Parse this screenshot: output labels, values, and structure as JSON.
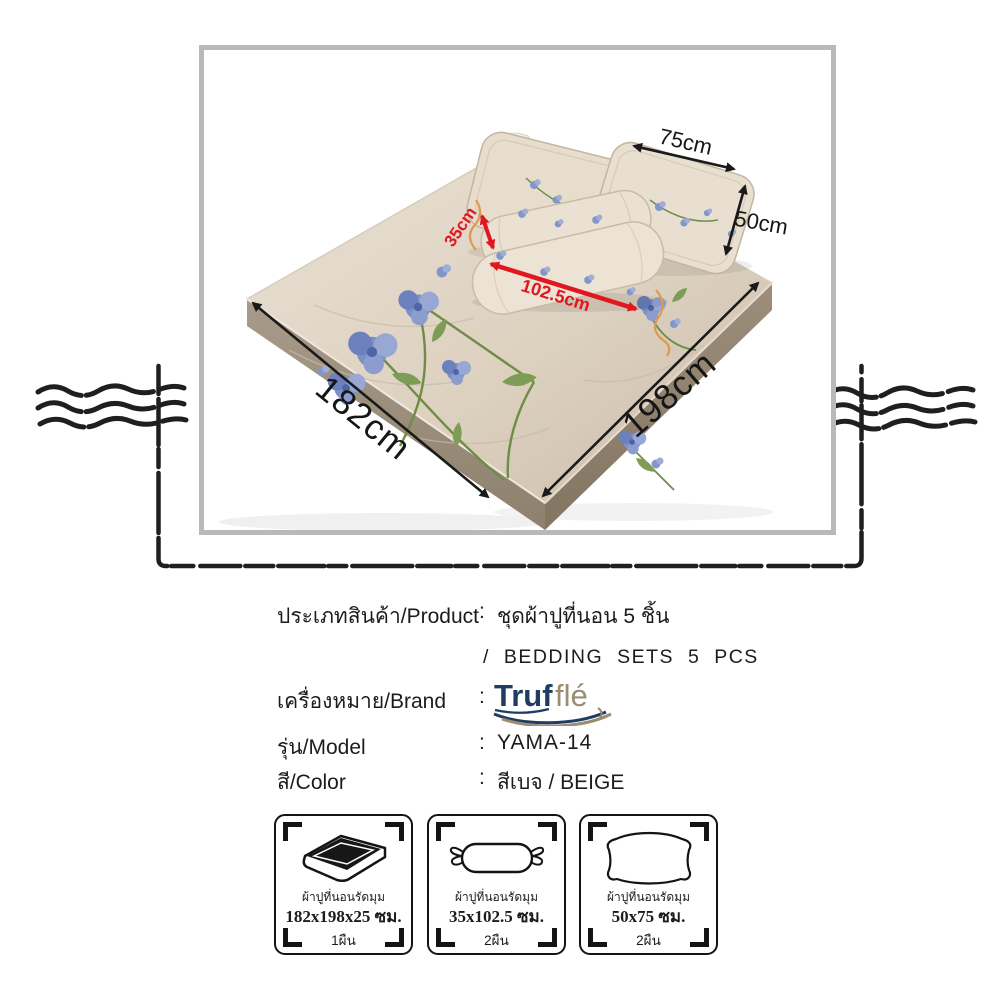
{
  "diagram": {
    "dimensions": {
      "pillow_width": "75cm",
      "pillow_height": "50cm",
      "bolster_diameter": "35cm",
      "bolster_length": "102.5cm",
      "bed_width": "182cm",
      "bed_length": "198cm"
    },
    "colors": {
      "arrow_black": "#1a1a1a",
      "arrow_red": "#e0171e",
      "frame_border_gray": "#b9b9b9",
      "sheet_beige": "#e2d7c7",
      "mattress_side_taupe": "#a0927f",
      "flower_blue": "#7a8dc5",
      "leaf_green": "#7d9c55",
      "ribbon_orange": "#de9950"
    }
  },
  "product_info": {
    "rows": [
      {
        "label": "ประเภทสินค้า/Product",
        "separator": ":",
        "value": "ชุดผ้าปูที่นอน 5 ชิ้น",
        "value_line2": "/ BEDDING SETS 5 PCS"
      },
      {
        "label": "เครื่องหมาย/Brand",
        "separator": ":",
        "value": "Trufflé"
      },
      {
        "label": "รุ่น/Model",
        "separator": ":",
        "value": "YAMA-14"
      },
      {
        "label": "สี/Color",
        "separator": ":",
        "value": "สีเบจ / BEIGE"
      }
    ],
    "brand_logo": {
      "part1": "Truf",
      "part2": "flé",
      "color1": "#1f3d63",
      "color2": "#9b8c72"
    }
  },
  "spec_boxes": [
    {
      "icon": "mattress-icon",
      "label": "ผ้าปูที่นอนรัดมุม",
      "size": "182x198x25 ซม.",
      "quantity": "1ผืน"
    },
    {
      "icon": "bolster-icon",
      "label": "ผ้าปูที่นอนรัดมุม",
      "size": "35x102.5 ซม.",
      "quantity": "2ผืน"
    },
    {
      "icon": "pillow-icon",
      "label": "ผ้าปูที่นอนรัดมุม",
      "size": "50x75 ซม.",
      "quantity": "2ผืน"
    }
  ]
}
